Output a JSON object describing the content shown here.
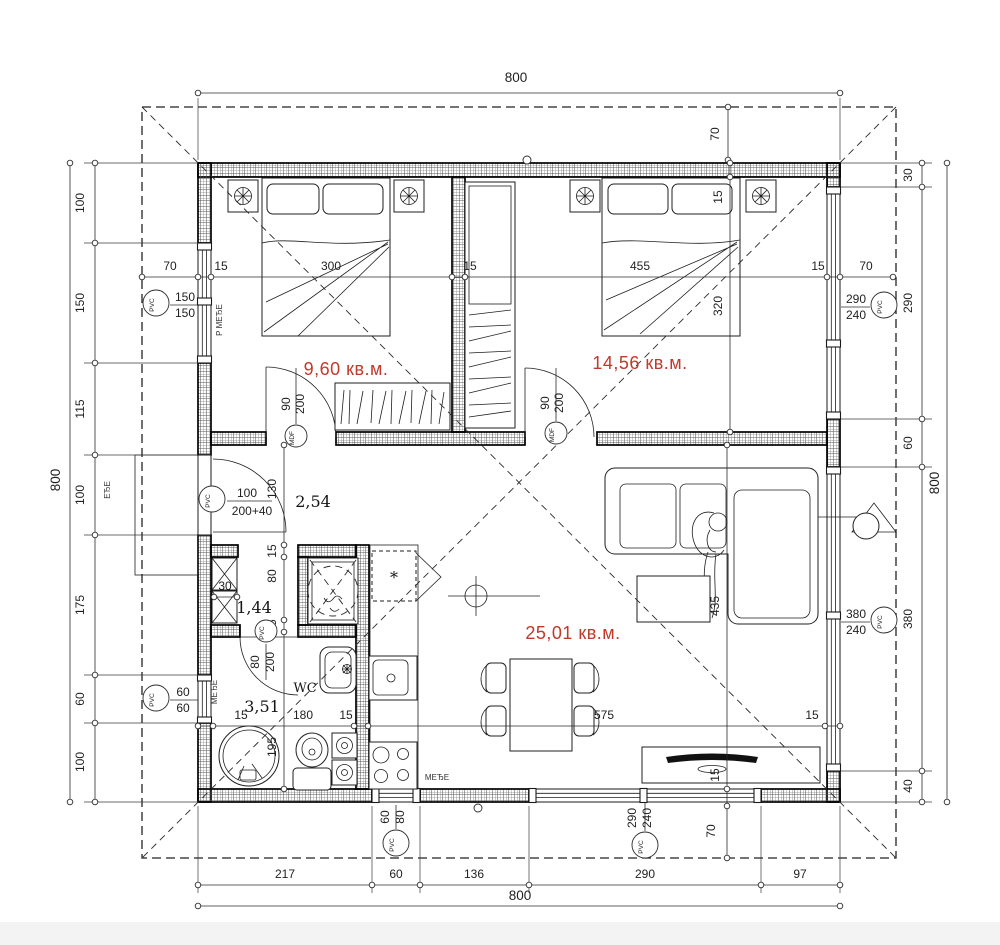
{
  "title": "floor-plan",
  "colors": {
    "accent_red": "#c0392b",
    "ink": "#1f1f1f"
  },
  "rooms": {
    "bedroom1_area": "9,60 кв.м.",
    "bedroom2_area": "14,56 кв.м.",
    "living_area": "25,01 кв.м.",
    "hall_area": "2,54",
    "closet_area": "1,44",
    "bathroom_area": "3,51",
    "wc_label": "WC"
  },
  "dims": {
    "overall_top": "800",
    "overall_bottom": "800",
    "overall_left": "800",
    "overall_right": "800",
    "offset_top": "70",
    "offset_bottom": "70",
    "left": [
      "100",
      "150",
      "115",
      "100",
      "175",
      "60",
      "100"
    ],
    "right": [
      "30",
      "290",
      "60",
      "380",
      "40"
    ],
    "bottom": [
      "217",
      "60",
      "136",
      "290",
      "97"
    ],
    "row_upper": [
      "70",
      "15",
      "300",
      "15",
      "455",
      "15",
      "70"
    ],
    "col_bedroom2": [
      "15",
      "320"
    ],
    "col_living": [
      "435",
      "15"
    ],
    "row_living": [
      "15",
      "180",
      "15",
      "575",
      "15"
    ],
    "col_bath": [
      "130",
      "15",
      "80",
      "15",
      "195"
    ],
    "closet_depth": "30"
  },
  "openings": {
    "window_left_top": {
      "material": "PVC",
      "w": "150",
      "h": "150"
    },
    "entry_door": {
      "material": "PVC",
      "w": "100",
      "h": "200+40"
    },
    "window_left_bottom": {
      "material": "PVC",
      "w": "60",
      "h": "60"
    },
    "bathroom_door": {
      "material": "PVC",
      "w": "80",
      "h": "200"
    },
    "bedroom1_door": {
      "material": "MDF",
      "w": "90",
      "h": "200"
    },
    "bedroom2_door": {
      "material": "MDF",
      "w": "90",
      "h": "200"
    },
    "window_right_top": {
      "material": "PVC",
      "w": "290",
      "h": "240"
    },
    "window_right_bottom": {
      "material": "PVC",
      "w": "380",
      "h": "240"
    },
    "window_bottom_left": {
      "material": "PVC",
      "w": "60",
      "h": "80"
    },
    "window_bottom_right": {
      "material": "PVC",
      "w": "290",
      "h": "240"
    }
  },
  "annotations": {
    "sill_left_top": "P МЕЂЕ",
    "sill_left_bottom": "МЕЂЕ",
    "sill_outside_left": "ЕЂЕ",
    "sill_kitchen": "МЕЂЕ",
    "fridge_mark": "*"
  }
}
